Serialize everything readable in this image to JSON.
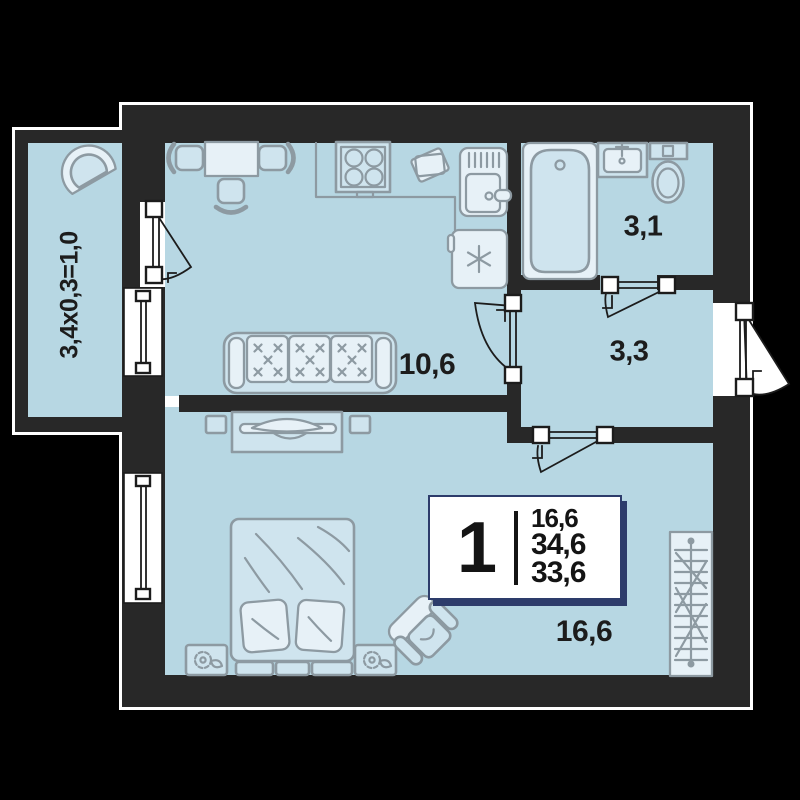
{
  "colors": {
    "background": "#000000",
    "wall": "#282828",
    "outline": "#ffffff",
    "floor": "#b7d7e3",
    "furniture_fill": "#cfe4ee",
    "furniture_light": "#e7f1f7",
    "furniture_stroke": "#8d9aa2",
    "line": "#1c1c1c",
    "card_accent": "#2d3c6b",
    "label_text": "#1c1c1c"
  },
  "labels": {
    "balcony": "3,4x0,3=1,0",
    "kitchen": "10,6",
    "bathroom": "3,1",
    "hallway": "3,3",
    "bedroom": "16,6"
  },
  "info_card": {
    "rooms_count": "1",
    "living_area": "16,6",
    "total_area": "34,6",
    "reduced_area": "33,6"
  }
}
